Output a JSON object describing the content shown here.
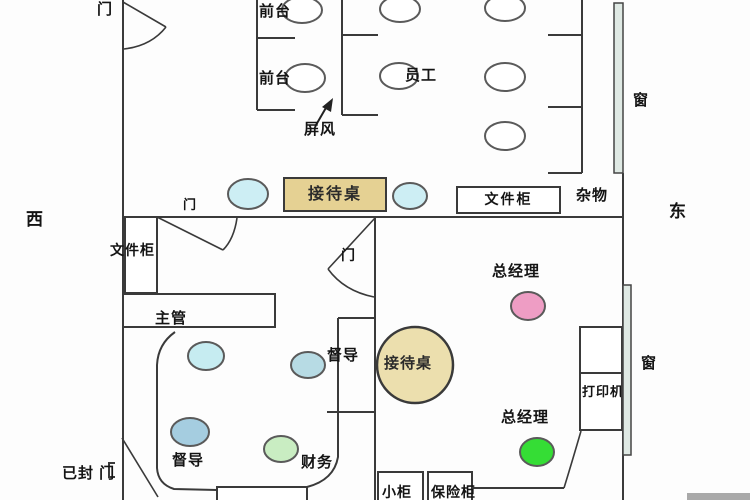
{
  "compass": {
    "west": "西",
    "east": "东"
  },
  "doors": {
    "top": "门",
    "small": "门",
    "middle": "门",
    "sealed": "已封 门"
  },
  "windows": {
    "top": "窗",
    "bottom": "窗"
  },
  "reception_area": {
    "front_desk_1": "前台",
    "front_desk_2": "前台",
    "staff": "员工",
    "screen": "屏风",
    "reception_desk": "接待桌",
    "file_cabinet": "文件柜",
    "sundries": "杂物"
  },
  "left_office": {
    "file_cabinet": "文件柜",
    "manager": "主管",
    "supervisor_1": "督导",
    "supervisor_2": "督导",
    "finance": "财务"
  },
  "gm_office": {
    "gm_1": "总经理",
    "gm_2": "总经理",
    "reception_table": "接待桌",
    "printer": "打印机",
    "small_cabinet": "小柜",
    "safe": "保险柜"
  },
  "colors": {
    "wall": "#3a3a3a",
    "chair_white": "#ffffff",
    "chair_cyan": "#cdeef4",
    "chair_cyan_light": "#c6ecf1",
    "chair_blue": "#b7dbe4",
    "chair_blue_deep": "#a5cde0",
    "chair_green_light": "#c9edc2",
    "chair_pink": "#ee9dc4",
    "chair_green_bright": "#35dd35",
    "desk_tan": "#e5d193",
    "table_tan": "#ecdfae",
    "window": "#dfe9e4",
    "scrollbar_gray": "#a9a9a9"
  }
}
